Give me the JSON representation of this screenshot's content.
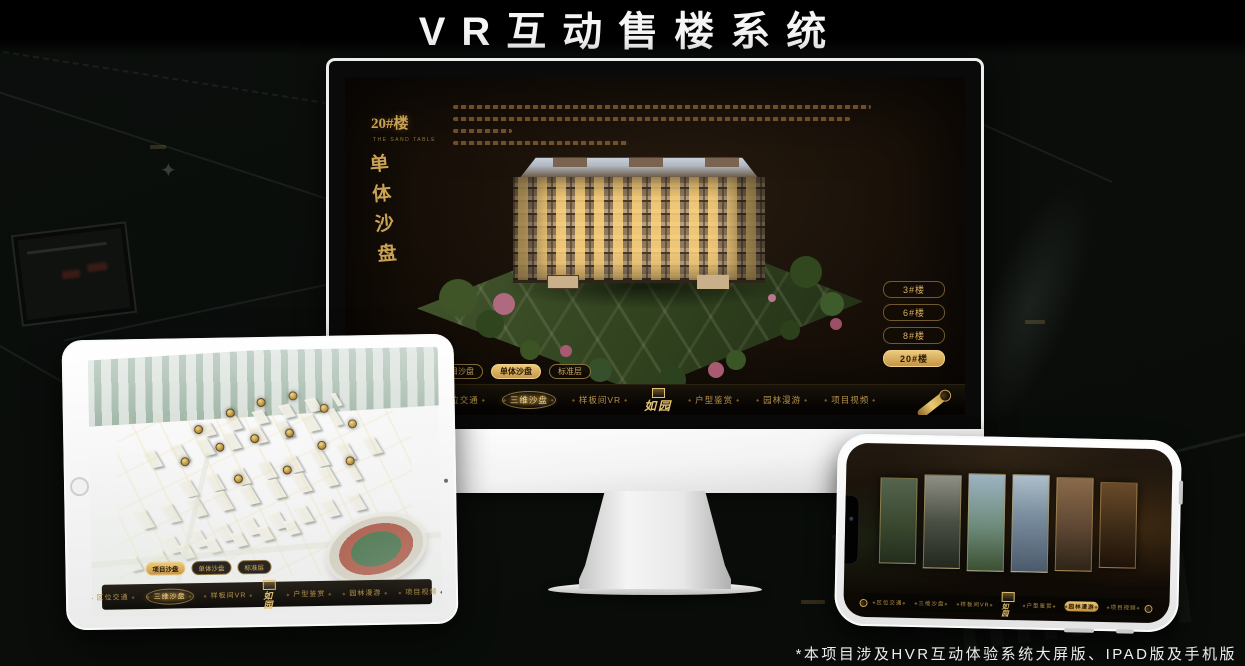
{
  "page": {
    "title": "VR互动售楼系统",
    "footnote": "*本项目涉及HVR互动体验系统大屏版、IPAD版及手机版"
  },
  "colors": {
    "gold_accent": "#c9a254",
    "gold_bright": "#eeca7a",
    "screen_background": "#170f08",
    "active_text_dark": "#261803"
  },
  "brand": {
    "logo_text": "如园"
  },
  "monitor": {
    "section_number": "20",
    "section_suffix": "#楼",
    "section_caption_en": "THE SAND TABLE",
    "section_title_vertical": [
      "单",
      "体",
      "沙",
      "盘"
    ],
    "floor_buttons": [
      {
        "label": "3#楼"
      },
      {
        "label": "6#楼"
      },
      {
        "label": "8#楼"
      },
      {
        "label": "20#楼",
        "active": true
      }
    ],
    "sub_tabs": [
      {
        "label": "项目沙盘"
      },
      {
        "label": "单体沙盘",
        "active": true
      },
      {
        "label": "标准层"
      }
    ],
    "nav_left": [
      {
        "label": "区位交通"
      },
      {
        "label": "三维沙盘",
        "active": true
      },
      {
        "label": "样板间VR"
      }
    ],
    "nav_right": [
      {
        "label": "户型鉴赏"
      },
      {
        "label": "园林漫游"
      },
      {
        "label": "项目视频"
      }
    ]
  },
  "tablet": {
    "sub_tabs": [
      {
        "label": "项目沙盘",
        "active": true
      },
      {
        "label": "单体沙盘"
      },
      {
        "label": "标准层"
      }
    ],
    "nav_left": [
      {
        "label": "区位交通"
      },
      {
        "label": "三维沙盘",
        "active": true
      },
      {
        "label": "样板间VR"
      }
    ],
    "nav_right": [
      {
        "label": "户型鉴赏"
      },
      {
        "label": "园林漫游"
      },
      {
        "label": "项目视频"
      }
    ]
  },
  "phone": {
    "nav_left": [
      {
        "label": "区位交通"
      },
      {
        "label": "三维沙盘"
      },
      {
        "label": "样板间VR"
      }
    ],
    "nav_right": [
      {
        "label": "户型鉴赏"
      },
      {
        "label": "园林漫游",
        "active": true
      },
      {
        "label": "项目视频"
      }
    ]
  }
}
